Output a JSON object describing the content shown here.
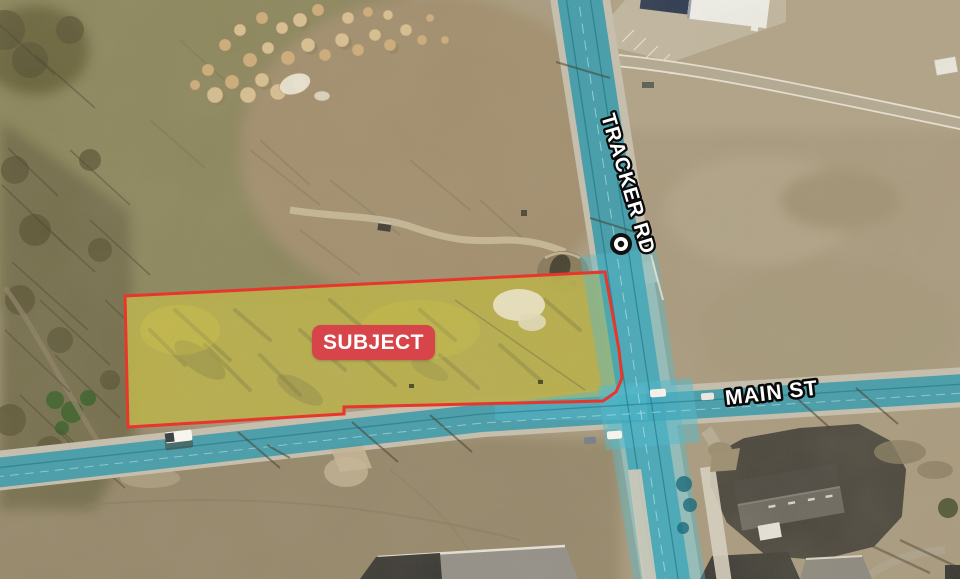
{
  "map_exhibit": {
    "type": "aerial-parcel-map",
    "subject_badge": {
      "label": "SUBJECT",
      "bg": "#d7444a",
      "text_color": "#ffffff"
    },
    "road_labels": {
      "tracker": "TRACKER RD",
      "main": "MAIN ST"
    },
    "colors": {
      "parcel_outline": "#e8362c",
      "parcel_fill": "#e0d43a",
      "road_highlight": "#2f97a9",
      "road_highlight_bright": "#55b9cb",
      "label_text": "#ffffff",
      "label_outline": "#0a0a0a"
    }
  }
}
